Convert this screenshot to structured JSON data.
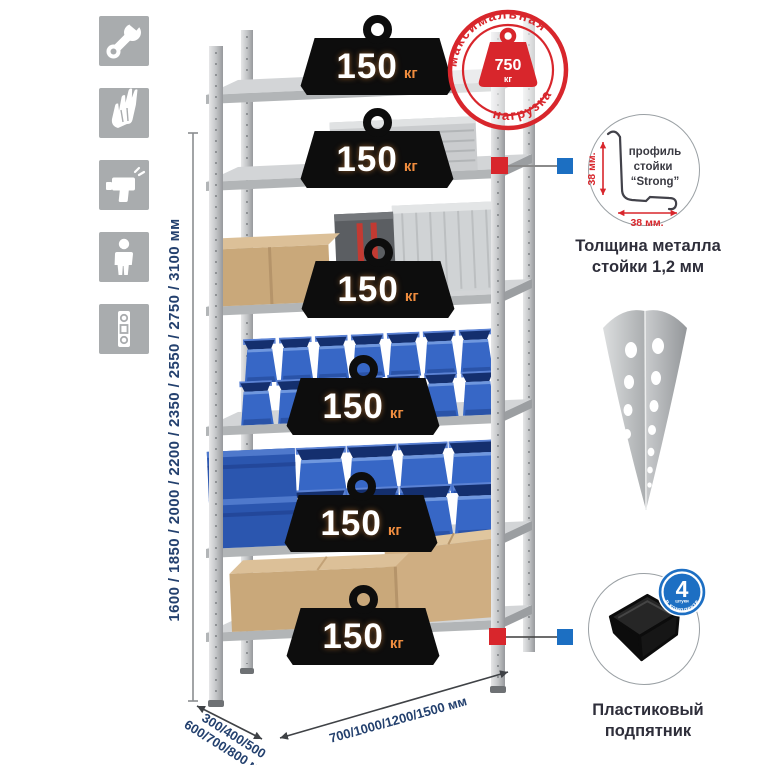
{
  "colors": {
    "accent_red": "#d8262c",
    "accent_blue": "#1c6fc2",
    "dimension_text": "#23406e",
    "icon_tile_gray": "#a9acae",
    "badge_black": "#0d0d0d",
    "badge_unit_orange": "#ef8c3e"
  },
  "assembly_icons": [
    {
      "name": "wrench"
    },
    {
      "name": "work-gloves"
    },
    {
      "name": "drill"
    },
    {
      "name": "person"
    },
    {
      "name": "spirit-level"
    }
  ],
  "rack": {
    "shelf_load_badges": [
      {
        "value": "150",
        "unit": "кг"
      },
      {
        "value": "150",
        "unit": "кг"
      },
      {
        "value": "150",
        "unit": "кг"
      },
      {
        "value": "150",
        "unit": "кг"
      },
      {
        "value": "150",
        "unit": "кг"
      },
      {
        "value": "150",
        "unit": "кг"
      }
    ],
    "height_options_label": "1600 / 1850 / 2000 / 2200 / 2350 / 2550 / 2750 / 3100 мм",
    "depth_options_line1": "300/400/500",
    "depth_options_line2": "600/700/800 мм",
    "width_options_label": "700/1000/1200/1500 мм"
  },
  "max_load_stamp": {
    "top_text": "максимальная",
    "bottom_text": "нагрузка",
    "weight_value": "750",
    "weight_unit": "кг"
  },
  "post_profile_detail": {
    "label_line1": "профиль",
    "label_line2": "стойки",
    "label_line3": "“Strong”",
    "vertical_dimension": "38 мм.",
    "horizontal_dimension": "38 мм.",
    "caption_line1": "Толщина металла",
    "caption_line2": "стойки 1,2 мм"
  },
  "foot_detail": {
    "badge_count": "4",
    "badge_count_sub": "штуки",
    "badge_arc_text": "в комплекте",
    "caption_line1": "Пластиковый",
    "caption_line2": "подпятник"
  }
}
